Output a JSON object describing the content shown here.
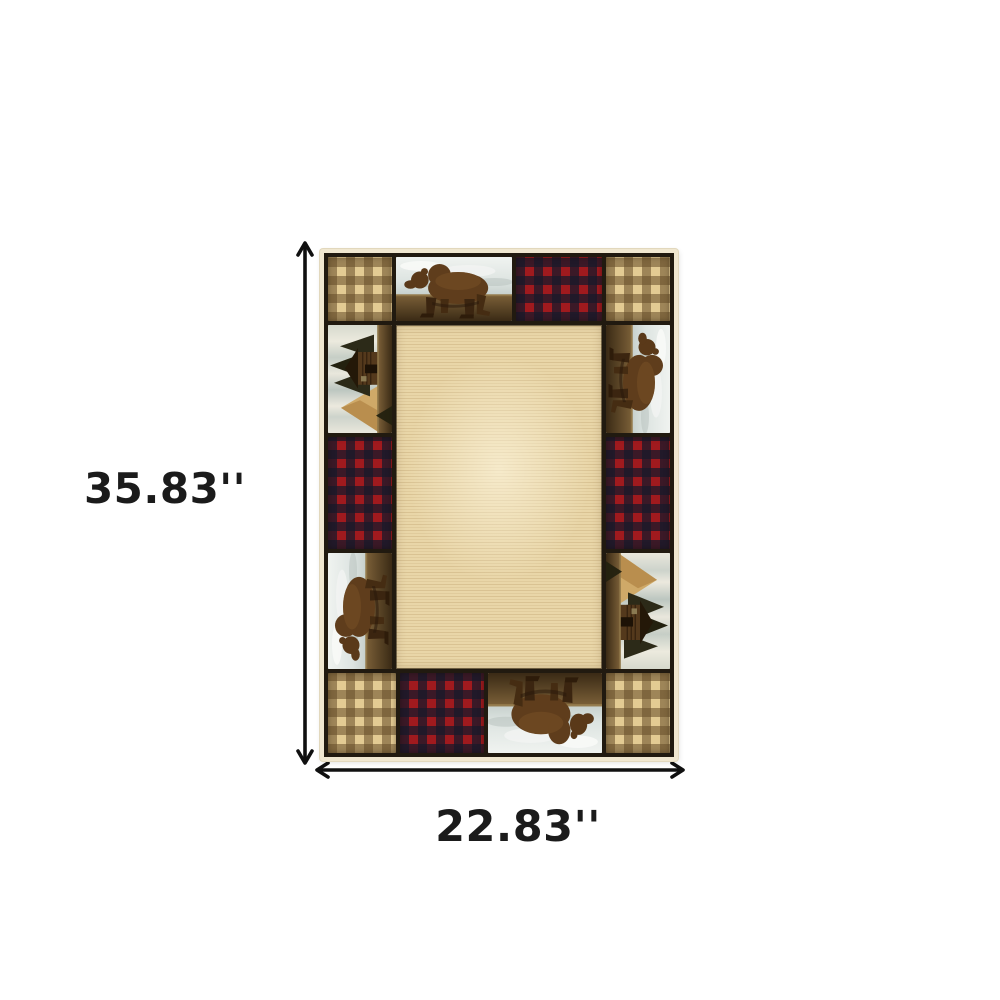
{
  "image_type": "product-dimension-illustration",
  "background_color": "#ffffff",
  "dimensions": {
    "height_label": "35.83''",
    "width_label": "22.83''"
  },
  "annotations": {
    "vertical_arrow": "double-headed-vertical-dimension-arrow",
    "horizontal_arrow": "double-headed-horizontal-dimension-arrow",
    "arrow_color": "#101010",
    "label_color": "#1b1b1b"
  },
  "rug": {
    "description": "Rectangular lodge-style area rug with a patchwork border of walking bears, log-cabin scenes, red buffalo plaid and tan gingham checks around a plain beige striated center field",
    "center_field": "plain beige field with horizontal striations",
    "palette": {
      "edge_cream": "#f0e7d0",
      "border_dark": "#211a10",
      "field_base": "#e9d6a8",
      "field_stripe": "#c9ad79",
      "gingham_light": "#e3cb93",
      "gingham_mid": "#b2905a",
      "gingham_dark": "#7a5f38",
      "plaid_red": "#a01a1e",
      "plaid_dark": "#23222f",
      "bear_brown": "#5f3d1c",
      "bear_dark": "#3b2510",
      "ground_brown": "#7b6038",
      "ground_dark": "#3a2a15",
      "sky_light": "#eef1ee",
      "sky_gray": "#c2ccc8",
      "birch_light": "#e9e7dc",
      "birch_gray": "#bcc6c0",
      "pine_dark": "#2c2a18",
      "cabin_brown": "#54391c",
      "mountain_tan": "#cfa968"
    },
    "patches": [
      {
        "position": "top-left-corner",
        "pattern": "tan-gingham-check"
      },
      {
        "position": "top-center-left",
        "pattern": "walking-bear-scene",
        "rotation": 0
      },
      {
        "position": "top-center-right",
        "pattern": "red-buffalo-plaid"
      },
      {
        "position": "top-right-corner",
        "pattern": "tan-gingham-check"
      },
      {
        "position": "left-upper",
        "pattern": "log-cabin-scene",
        "rotation": -90
      },
      {
        "position": "left-middle",
        "pattern": "red-buffalo-plaid"
      },
      {
        "position": "left-lower",
        "pattern": "walking-bear-scene",
        "rotation": -90
      },
      {
        "position": "right-upper",
        "pattern": "walking-bear-scene",
        "rotation": 90
      },
      {
        "position": "right-middle",
        "pattern": "red-buffalo-plaid"
      },
      {
        "position": "right-lower",
        "pattern": "log-cabin-scene",
        "rotation": 90
      },
      {
        "position": "bottom-left-corner",
        "pattern": "tan-gingham-check"
      },
      {
        "position": "bottom-center-left",
        "pattern": "red-buffalo-plaid"
      },
      {
        "position": "bottom-center-right",
        "pattern": "walking-bear-scene",
        "rotation": 180
      },
      {
        "position": "bottom-right-corner",
        "pattern": "tan-gingham-check"
      }
    ]
  }
}
